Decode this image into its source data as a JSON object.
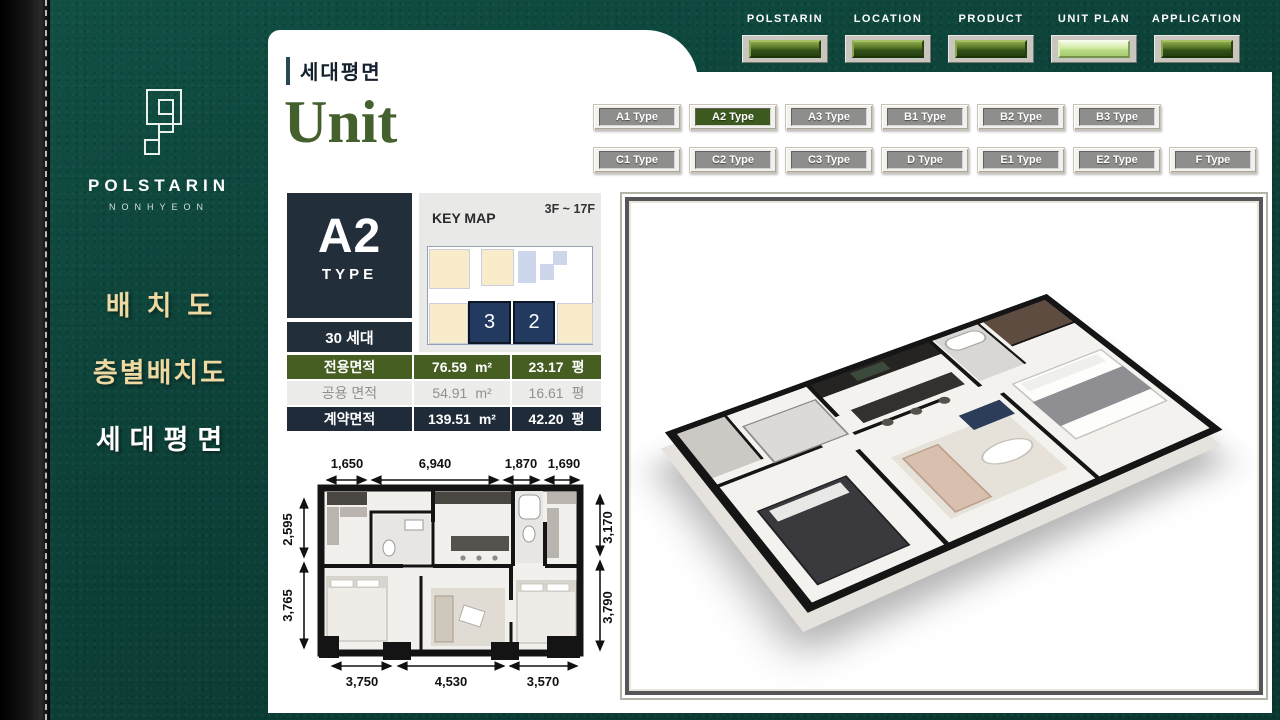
{
  "brand": {
    "name": "POLSTARIN",
    "subname": "NONHYEON"
  },
  "sidebar_menu": [
    {
      "label": "배치도",
      "active": false
    },
    {
      "label": "층별배치도",
      "active": false
    },
    {
      "label": "세대평면",
      "active": true
    }
  ],
  "nav": [
    {
      "label": "POLSTARIN",
      "active": false
    },
    {
      "label": "LOCATION",
      "active": false
    },
    {
      "label": "PRODUCT",
      "active": false
    },
    {
      "label": "UNIT PLAN",
      "active": true
    },
    {
      "label": "APPLICATION",
      "active": false
    }
  ],
  "header": {
    "breadcrumb": "세대평면",
    "title": "Unit"
  },
  "types": {
    "row1": [
      "A1 Type",
      "A2 Type",
      "A3 Type",
      "B1 Type",
      "B2 Type",
      "B3 Type"
    ],
    "row2": [
      "C1 Type",
      "C2 Type",
      "C3 Type",
      "D Type",
      "E1 Type",
      "E2 Type",
      "F Type"
    ],
    "active": "A2 Type"
  },
  "unit": {
    "type": "A2",
    "type_label": "TYPE",
    "households": "30 세대",
    "floors": "3F ~ 17F",
    "keymap_title": "KEY MAP",
    "keymap_cell_left": "3",
    "keymap_cell_right": "2"
  },
  "area_table": {
    "rows": [
      {
        "label": "전용면적",
        "sqm": "76.59",
        "sqm_unit": "m²",
        "pyeong": "23.17",
        "pyeong_unit": "평"
      },
      {
        "label": "공용 면적",
        "sqm": "54.91",
        "sqm_unit": "m²",
        "pyeong": "16.61",
        "pyeong_unit": "평"
      },
      {
        "label": "계약면적",
        "sqm": "139.51",
        "sqm_unit": "m²",
        "pyeong": "42.20",
        "pyeong_unit": "평"
      }
    ]
  },
  "floor_plan": {
    "dims_top": [
      "1,650",
      "6,940",
      "1,870",
      "1,690"
    ],
    "dims_left": [
      "2,595",
      "3,765"
    ],
    "dims_right": [
      "3,170",
      "3,790"
    ],
    "dims_bottom": [
      "3,750",
      "4,530",
      "3,570"
    ]
  },
  "colors": {
    "background_teal": "#0d4239",
    "leather_black": "#0a0a0a",
    "panel_white": "#ffffff",
    "title_green": "#44602c",
    "table_green": "#465e22",
    "table_navy": "#1f2b38",
    "card_navy": "#232e3b",
    "keymap_cream": "#f9ecca",
    "keymap_navy": "#223a60",
    "nav_button_green": "#3d5a1c",
    "nav_button_active": "#c9e69d",
    "type_button_gray": "#8e8e8c",
    "type_button_active": "#3c5a1e",
    "menu_gold": "#eed9a2"
  }
}
